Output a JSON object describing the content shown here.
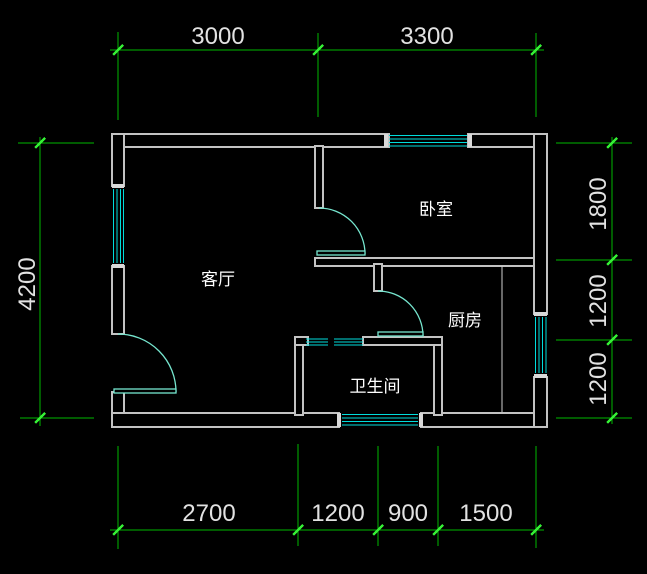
{
  "canvas": {
    "width": 647,
    "height": 574,
    "background": "#000000"
  },
  "colors": {
    "wall": "#c3c3c3",
    "window": "#00dcdc",
    "door": "#76e6cf",
    "dimension_line": "#00b800",
    "dimension_tick": "#35ef35",
    "dimension_text": "#e2e2e2",
    "room_label": "#ffffff"
  },
  "rooms": [
    {
      "id": "living-room",
      "label": "客厅"
    },
    {
      "id": "bedroom",
      "label": "卧室"
    },
    {
      "id": "kitchen",
      "label": "厨房"
    },
    {
      "id": "bathroom",
      "label": "卫生间"
    }
  ],
  "dimensions": {
    "top": [
      "3000",
      "3300"
    ],
    "bottom": [
      "2700",
      "1200",
      "900",
      "1500"
    ],
    "left": [
      "4200"
    ],
    "right": [
      "1800",
      "1200",
      "1200"
    ]
  }
}
